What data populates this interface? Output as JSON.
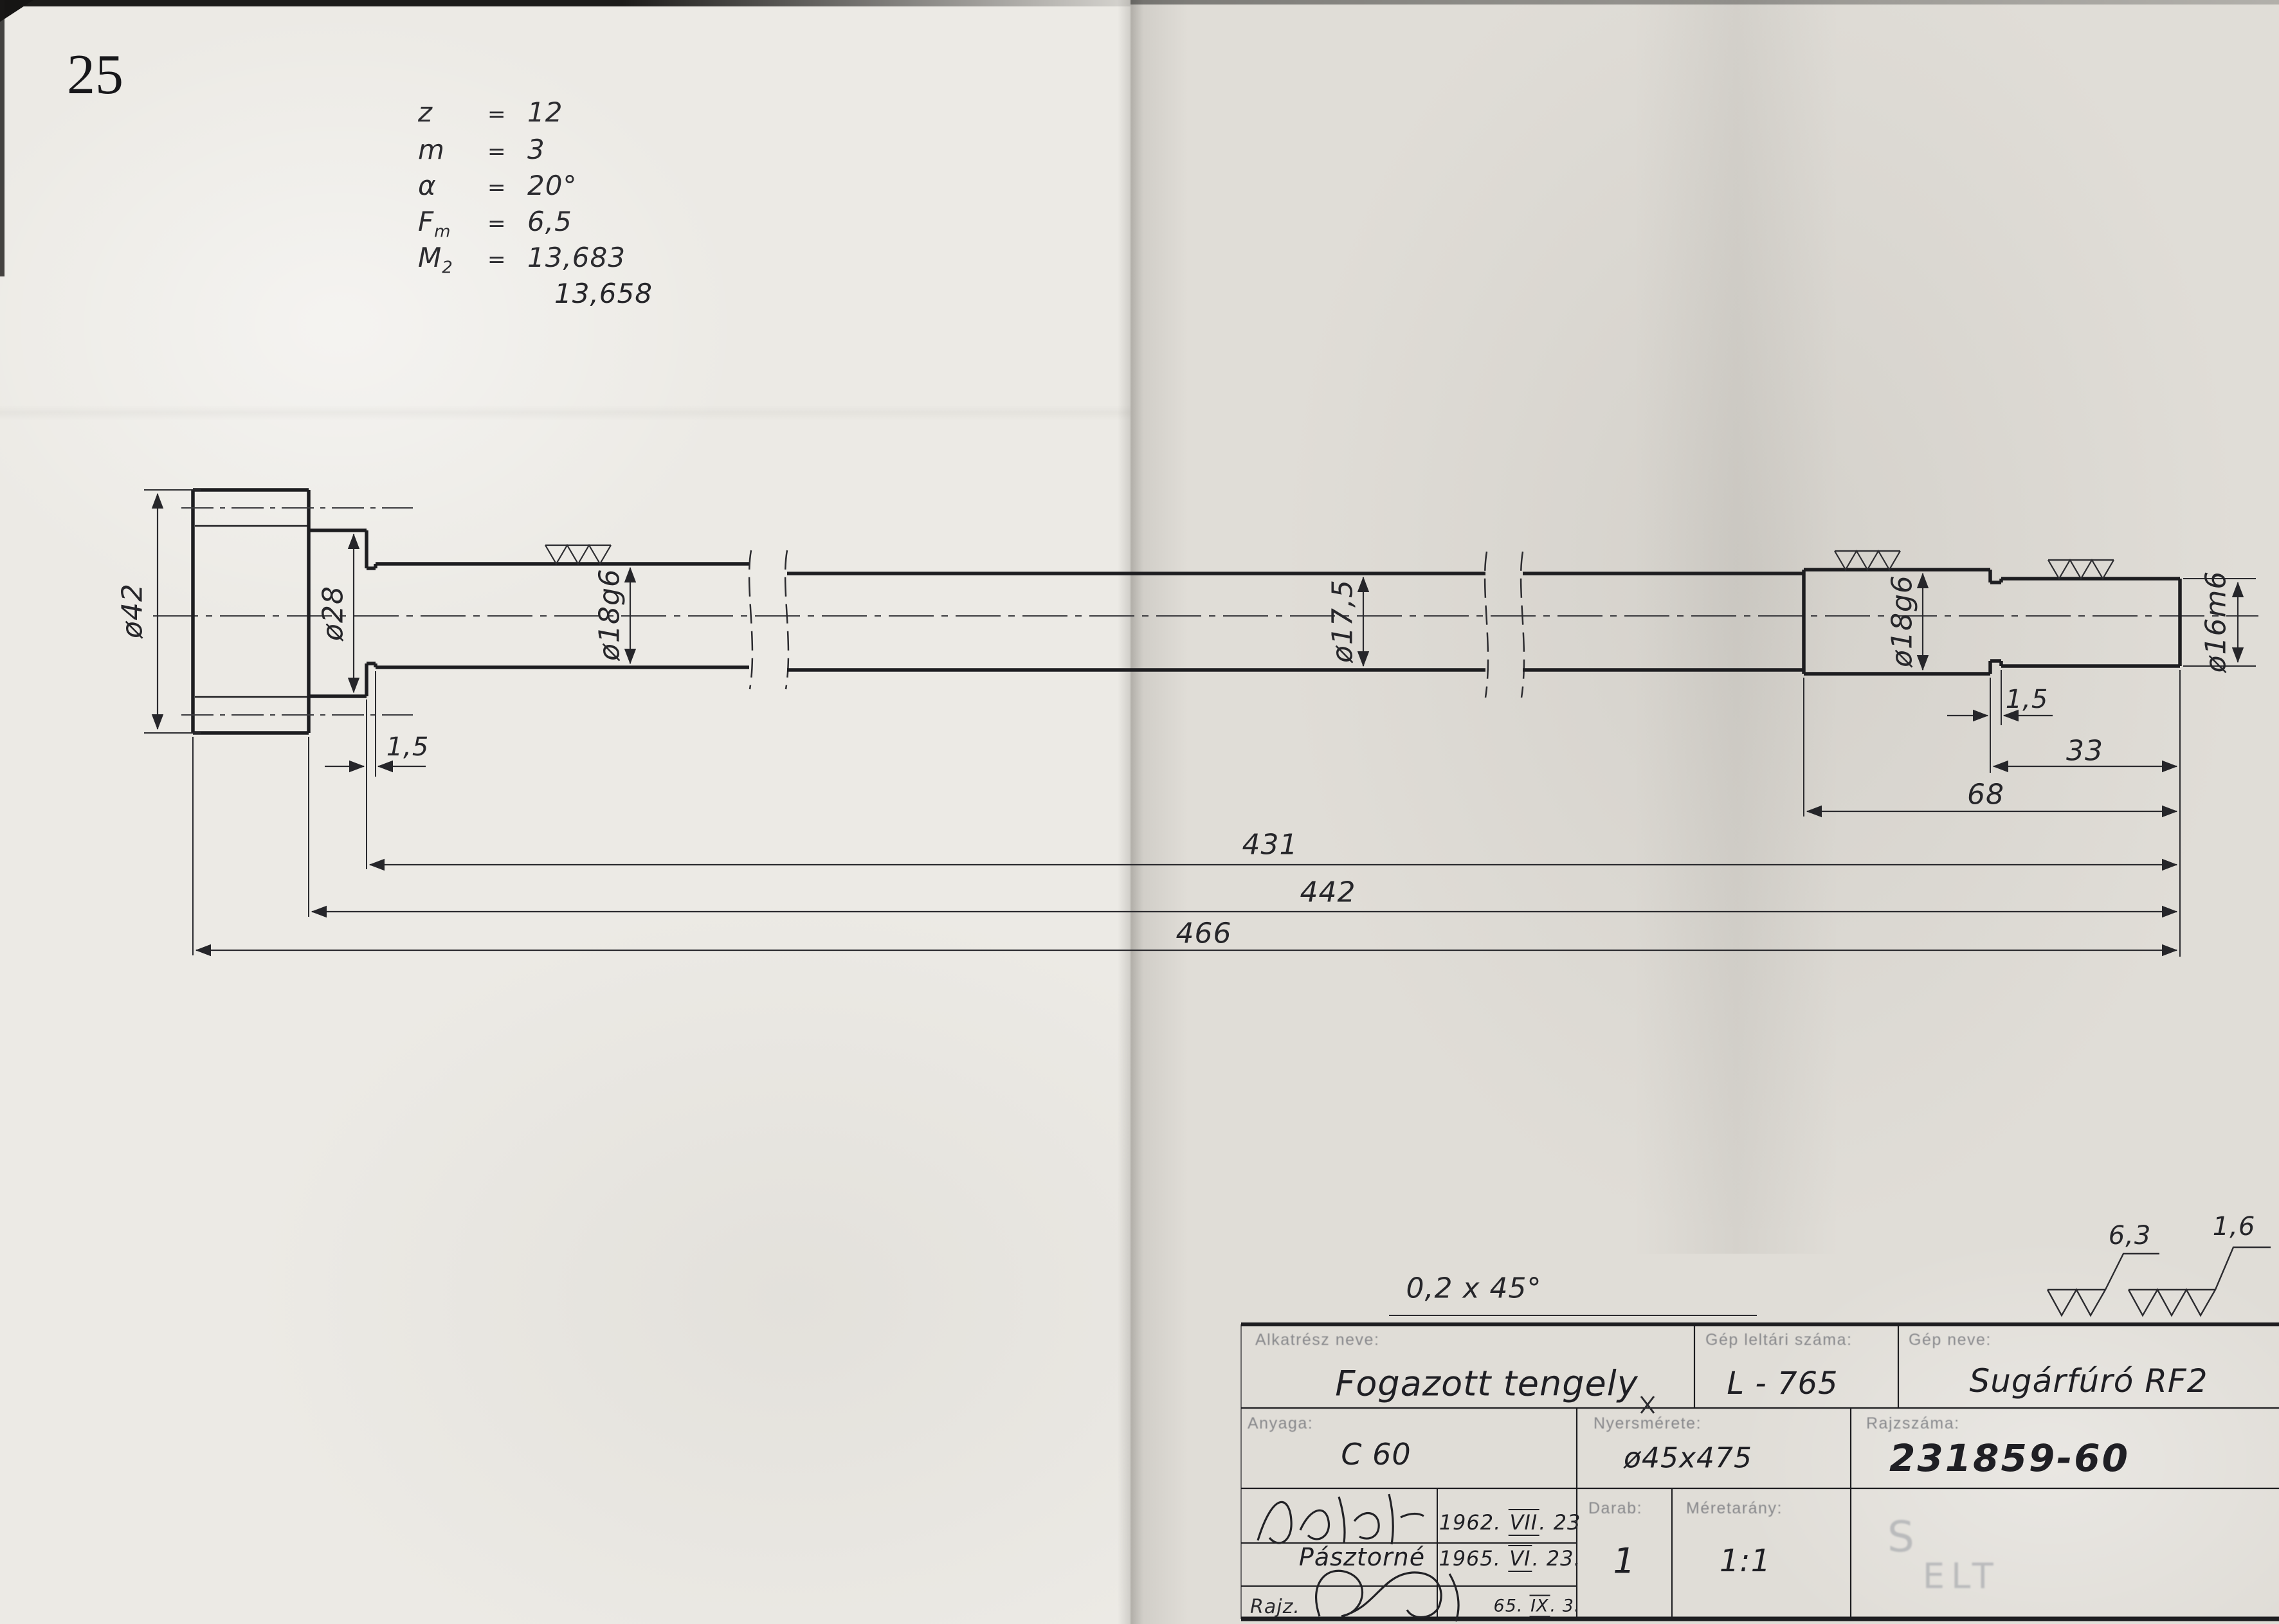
{
  "page_number": "25",
  "parameters": {
    "eq": "=",
    "rows": [
      {
        "sym": "z",
        "sub": "",
        "val": "12"
      },
      {
        "sym": "m",
        "sub": "",
        "val": "3"
      },
      {
        "sym": "α",
        "sub": "",
        "val": "20°"
      },
      {
        "sym": "F",
        "sub": "m",
        "val": "6,5"
      },
      {
        "sym": "M",
        "sub": "2",
        "val": "13,683"
      }
    ],
    "extra_value": "13,658"
  },
  "drawing": {
    "dia_gear": "ø42",
    "dia_collar": "ø28",
    "dia_journal_left": "ø18g6",
    "dia_middle": "ø17,5",
    "dia_journal_right": "ø18g6",
    "dia_end": "ø16m6",
    "groove_left": "1,5",
    "groove_right": "1,5",
    "len_end": "33",
    "len_right": "68",
    "len_431": "431",
    "len_442": "442",
    "len_466": "466",
    "chamfer_note": "0,2 x 45°"
  },
  "roughness_legend": {
    "coarse": "6,3",
    "fine": "1,6"
  },
  "title_block": {
    "part_name_label": "Alkatrész neve:",
    "part_name": "Fogazott tengely",
    "machine_no_label": "Gép leltári száma:",
    "machine_no": "L - 765",
    "machine_name_label": "Gép neve:",
    "machine_name": "Sugárfúró RF2",
    "material_label": "Anyaga:",
    "material": "C 60",
    "stock_label": "Nyersmérete:",
    "stock": "ø45x475",
    "number_label": "Rajzszáma:",
    "number": "231859-60",
    "qty_label": "Darab:",
    "qty": "1",
    "scale_label": "Méretarány:",
    "scale": "1:1",
    "signer2": "Pásztorné",
    "drawn_label": "Rajz.",
    "dates": {
      "d1": {
        "y": "1962.",
        "m": "VII",
        "d": ". 23"
      },
      "d2": {
        "y": "1965.",
        "m": "VI",
        "d": ". 23."
      },
      "d3": {
        "y": "65.",
        "m": "IX",
        "d": ". 3."
      }
    },
    "stamp_s": "S",
    "stamp_text": "ELT"
  }
}
